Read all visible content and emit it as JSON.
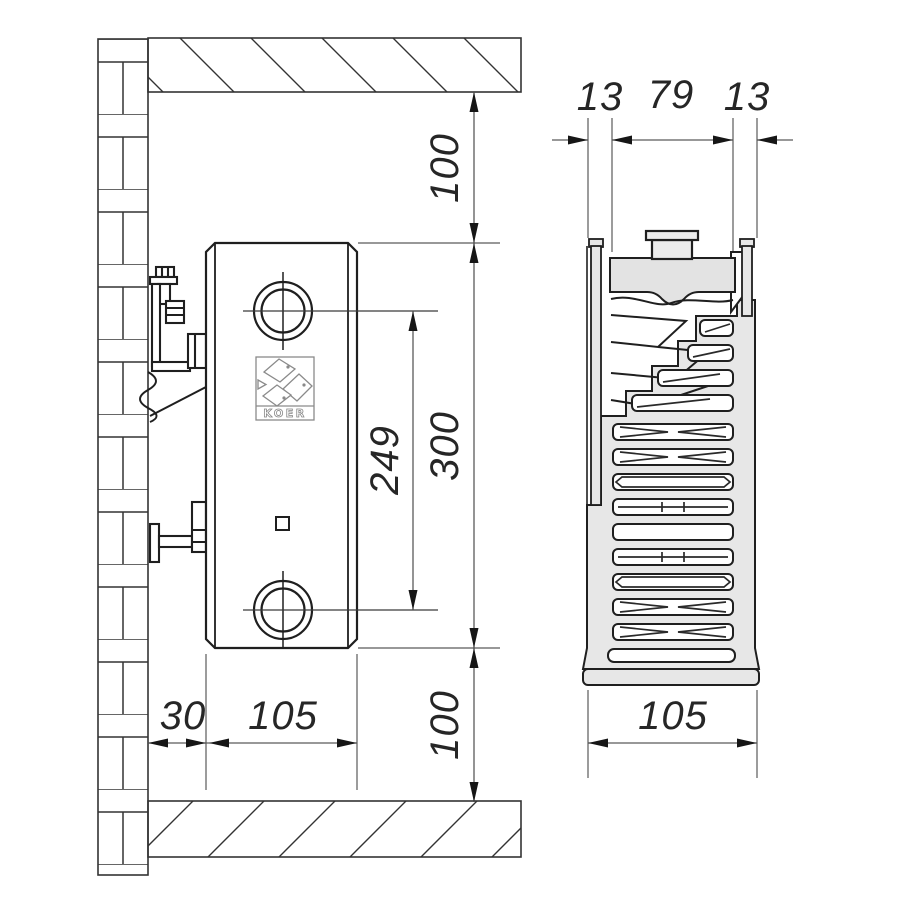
{
  "title": "KOER panel radiator installation drawing",
  "brand": {
    "logo_text": "KOER"
  },
  "dims": {
    "side": {
      "ceiling_clearance": "100",
      "height": "300",
      "connection_spacing": "249",
      "floor_clearance": "100",
      "wall_gap": "30",
      "depth": "105"
    },
    "section": {
      "front_panel": "13",
      "core_width": "79",
      "rear_panel": "13",
      "total_depth": "105"
    }
  },
  "colors": {
    "outline": "#222222",
    "thin_line": "#5a5a5a",
    "fill_light": "#e7e7e7",
    "fill_header": "#e3e3e3",
    "background": "#ffffff"
  }
}
